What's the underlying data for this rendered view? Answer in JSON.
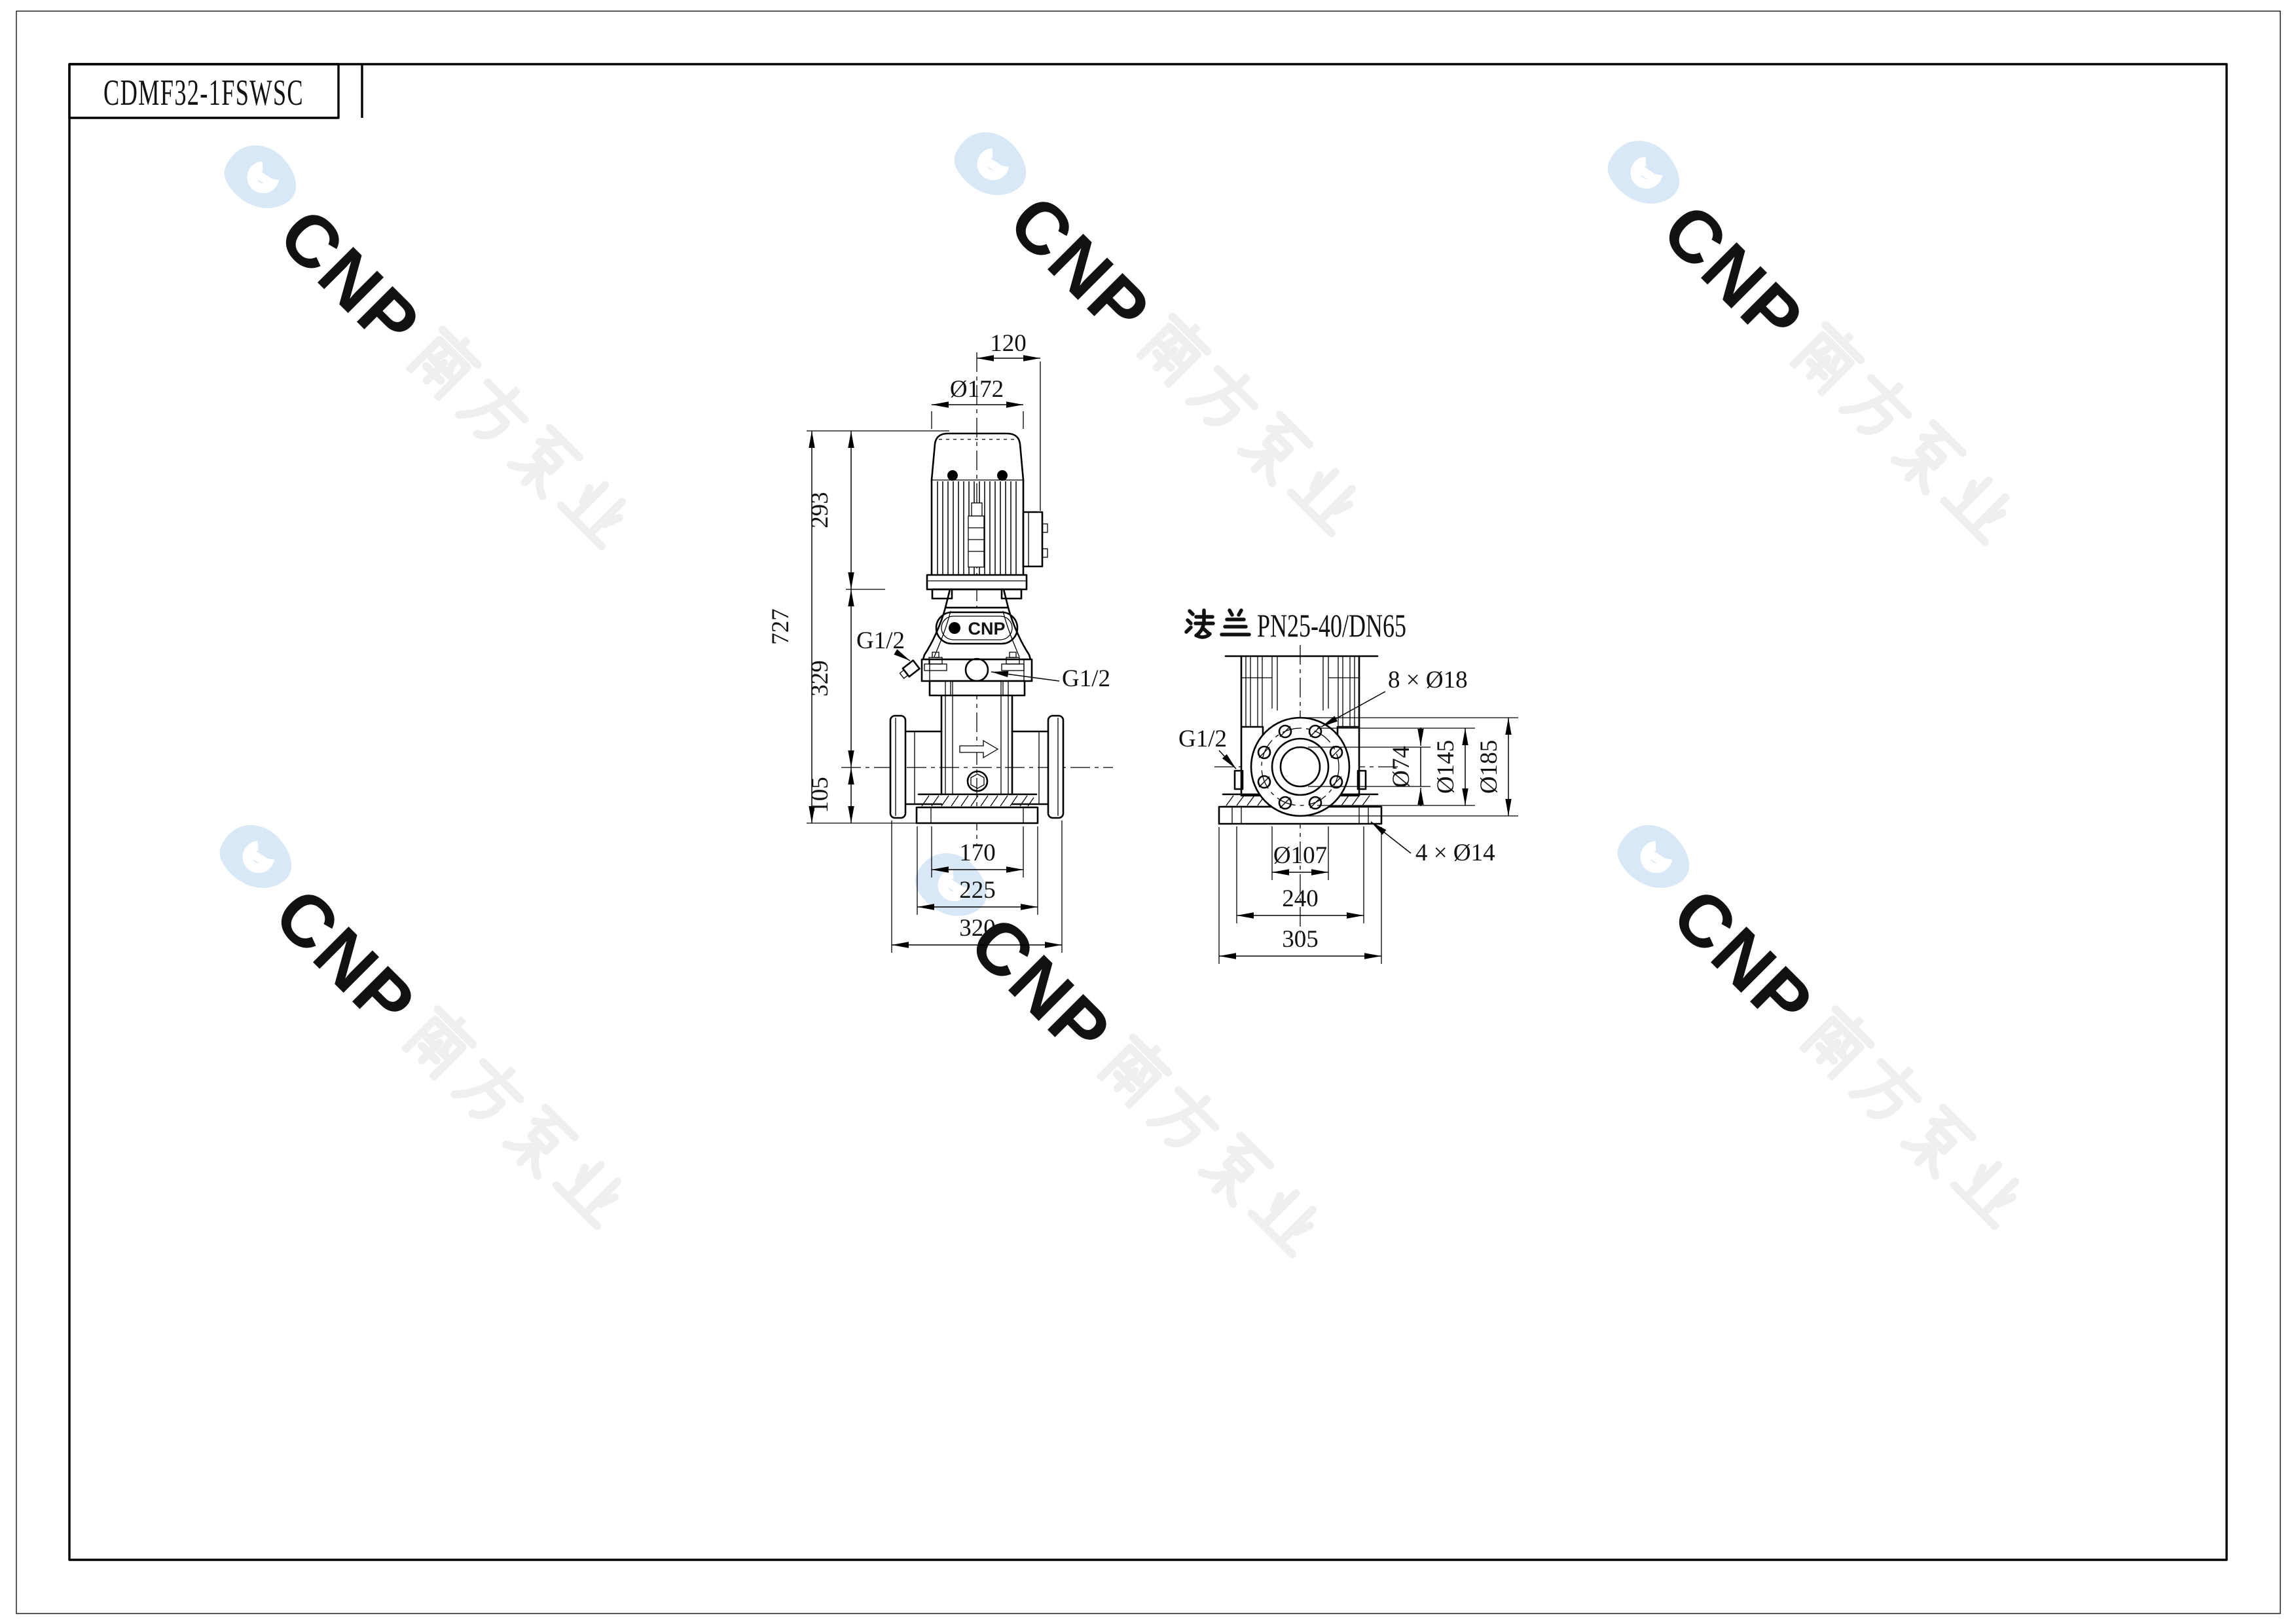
{
  "title_block": {
    "model": "CDMF32-1FSWSC"
  },
  "watermark": {
    "brand": "CNP",
    "brand_cn": "南方泵业",
    "logo_color": "#d8e8f6",
    "text_color": "#edeff1"
  },
  "front_view": {
    "badge": "CNP",
    "port_left": "G1/2",
    "port_right": "G1/2",
    "dim_top_width": "120",
    "dim_motor_dia": "Ø172",
    "dim_motor_height": "293",
    "dim_total_height": "727",
    "dim_mid_height": "329",
    "dim_base_height": "105",
    "dim_inner_width": "170",
    "dim_base_width": "225",
    "dim_overall_width": "320"
  },
  "side_view": {
    "flange_title": "法兰PN25-40/DN65",
    "flange_title_cn": "法兰",
    "flange_title_latin": "PN25-40/DN65",
    "port": "G1/2",
    "dim_bolt_holes": "8 × Ø18",
    "dim_bore": "Ø74",
    "dim_bolt_circle": "Ø145",
    "dim_flange_od": "Ø185",
    "dim_base_holes": "4 × Ø14",
    "dim_raised_face": "Ø107",
    "dim_hole_spacing": "240",
    "dim_base_width": "305"
  }
}
